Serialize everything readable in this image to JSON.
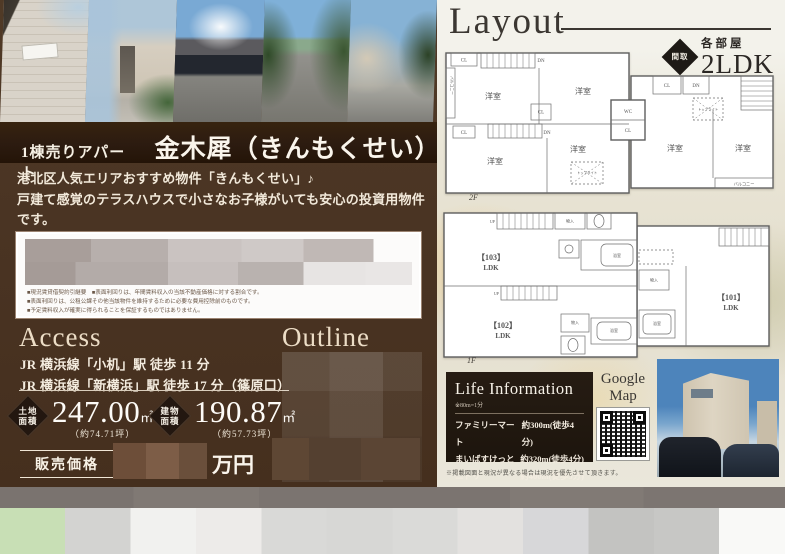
{
  "colors": {
    "panel_brown": "#4a3423",
    "title_bar_brown": "#2c1b10",
    "badge_dark": "#231710",
    "cream_text": "#f2e9da",
    "right_panel_bg": "#e9e5d6",
    "life_box_dark": "#201810",
    "gray_bar": "#7b7470",
    "footer_green_block": "#c8dfb5"
  },
  "left": {
    "title": {
      "prefix": "1棟売りアパート",
      "name": "金木犀（きんもくせい）"
    },
    "description": [
      "港北区人気エリアおすすめ物件「きんもくせい」♪",
      "戸建て感覚のテラスハウスで小さなお子様がいても安心の投資用物件です。",
      "ミサワホーム施工・省令準耐火構造"
    ],
    "notice": {
      "disclaimers": [
        "■現況賃貸借契約引継要　■表面利回りは、年間賃料収入の当該不動産価格に対する割合です。",
        "■表面利回りは、公租公課その他当該物件を維持するために必要な費用控除前のものです。",
        "■予定賃料収入が確実に得られることを保証するものではありません。"
      ]
    },
    "access": {
      "heading": "Access",
      "lines": [
        "JR 横浜線「小机」駅 徒歩 11 分",
        "JR 横浜線「新横浜」駅 徒歩 17 分（篠原口）"
      ]
    },
    "outline": {
      "heading": "Outline"
    },
    "land": {
      "badge_l1": "土地",
      "badge_l2": "面積",
      "value": "247.00",
      "unit": "㎡",
      "tsubo": "（約74.71坪）"
    },
    "building": {
      "badge_l1": "建物",
      "badge_l2": "面積",
      "value": "190.87",
      "unit": "㎡",
      "tsubo": "（約57.73坪）"
    },
    "price": {
      "label": "販売価格",
      "unit": "万円"
    }
  },
  "right": {
    "layout_heading": "Layout",
    "madori": {
      "diamond": "間取",
      "rooms": "各部屋",
      "type": "2LDK"
    },
    "floors": {
      "f2": "2F",
      "f1": "1F"
    },
    "plan_labels": {
      "yoshitsu": "洋室",
      "cl": "CL",
      "wc": "WC",
      "dn": "DN",
      "up": "UP",
      "balcony": "バルコニー",
      "monoire": "物入",
      "bath": "浴室",
      "toplight": "トップライト",
      "unit101": "【101】",
      "unit102": "【102】",
      "unit103": "【103】",
      "ldk": "LDK"
    },
    "life": {
      "title": "Life Information",
      "note": "※80m=1分",
      "items": [
        {
          "name": "ファミリーマート",
          "value": "約300m(徒歩4分)"
        },
        {
          "name": "まいばすけっと",
          "value": "約320m(徒歩4分)"
        },
        {
          "name": "ニトリ",
          "value": "約400m(徒歩5分)"
        }
      ]
    },
    "gmap": {
      "line1": "Google",
      "line2": "Map"
    },
    "bottom_note": "※掲載図面と現況が異なる場合は現況を優先させて頂きます。"
  }
}
